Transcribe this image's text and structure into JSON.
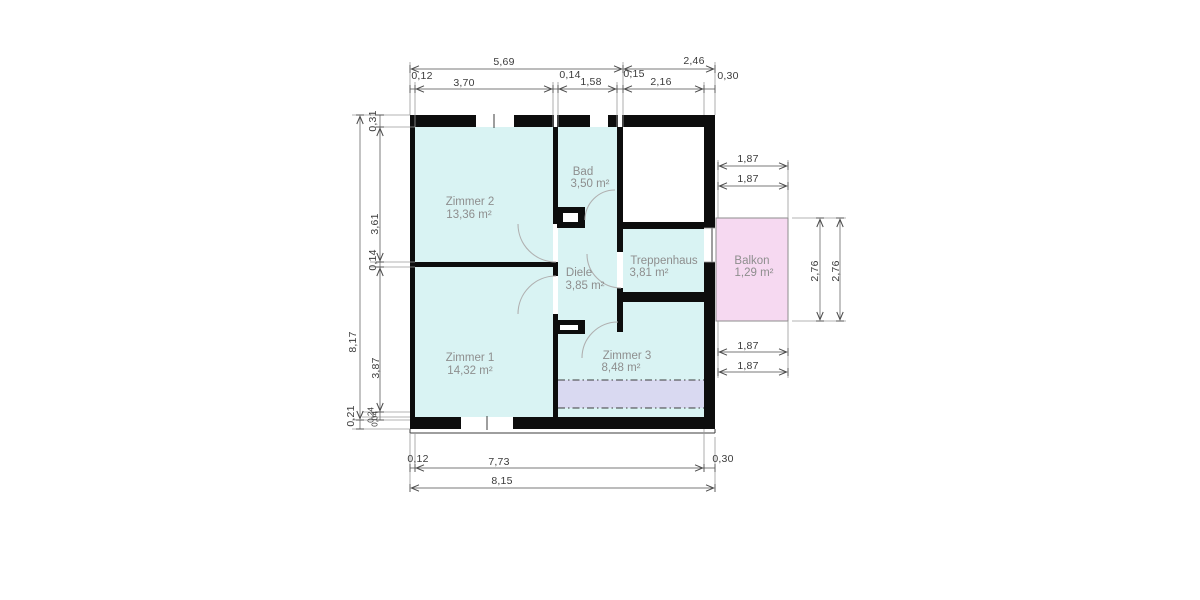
{
  "plan": {
    "rooms": [
      {
        "name": "Zimmer 2",
        "area": "13,36 m²"
      },
      {
        "name": "Bad",
        "area": "3,50 m²"
      },
      {
        "name": "Zimmer 1",
        "area": "14,32 m²"
      },
      {
        "name": "Diele",
        "area": "3,85 m²"
      },
      {
        "name": "Treppenhaus",
        "area": "3,81 m²"
      },
      {
        "name": "Zimmer 3",
        "area": "8,48 m²"
      },
      {
        "name": "Balkon",
        "area": "1,29 m²"
      }
    ],
    "dimensions": {
      "top": {
        "totals": [
          "5,69",
          "2,46"
        ],
        "segments": [
          "0,12",
          "3,70",
          "0,14",
          "1,58",
          "0,15",
          "2,16",
          "0,30"
        ]
      },
      "left": {
        "totals": [
          "8,17",
          "0,21"
        ],
        "segments": [
          "0,31",
          "3,61",
          "0,14",
          "3,87",
          "0,24",
          "0,04"
        ]
      },
      "right": {
        "top": [
          "1,87",
          "1,87"
        ],
        "side": [
          "2,76",
          "2,76"
        ],
        "bottom": [
          "1,87",
          "1,87"
        ]
      },
      "bottom": {
        "segments": [
          "0,12",
          "7,73",
          "0,30"
        ],
        "total": "8,15"
      }
    },
    "colors": {
      "room_fill": "#d9f3f3",
      "attic_strip": "#d9d9f1",
      "balcony_fill": "#f6d9f1",
      "wall": "#0d0d0d"
    }
  }
}
